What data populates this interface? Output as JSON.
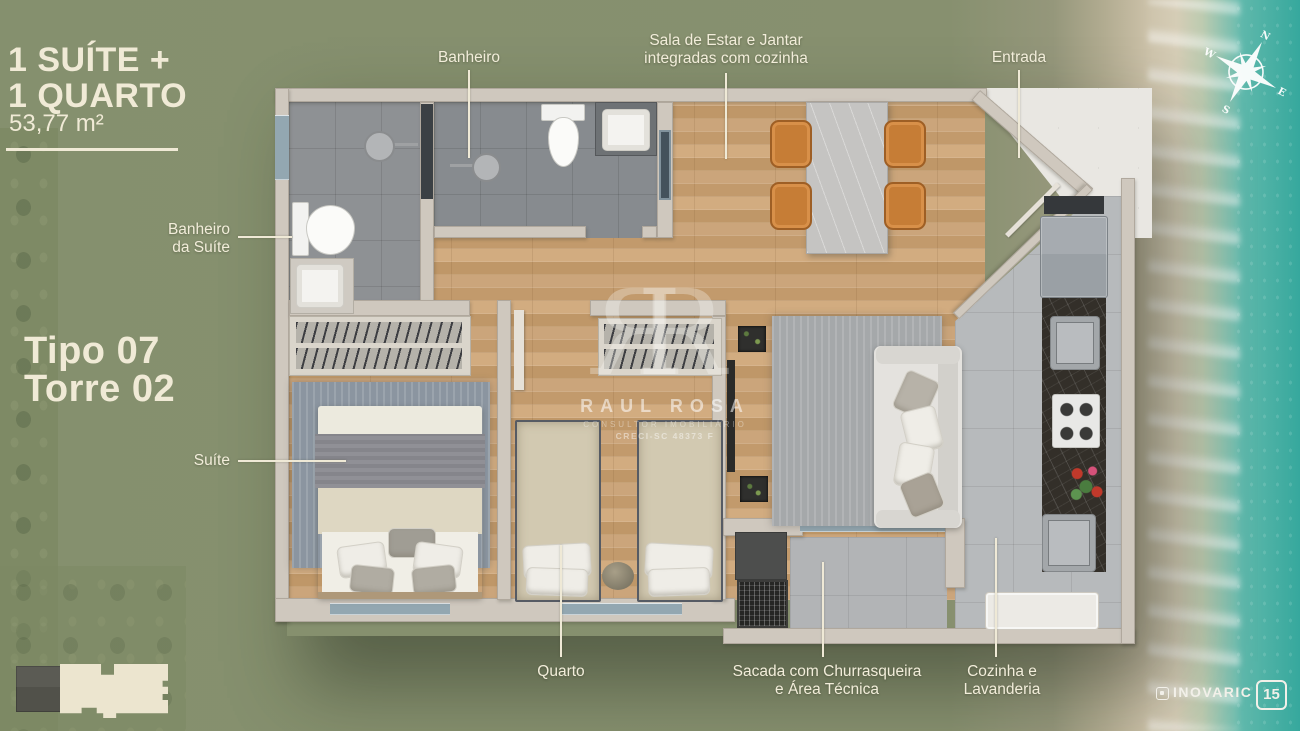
{
  "title_block": {
    "line1": "1 SUÍTE +",
    "line2": "1 QUARTO",
    "area": "53,77 m²"
  },
  "unit_block": {
    "line1": "Tipo 07",
    "line2": "Torre 02"
  },
  "callouts": {
    "banheiro": {
      "label": "Banheiro"
    },
    "sala": {
      "line1": "Sala de Estar e Jantar",
      "line2": "integradas com cozinha"
    },
    "entrada": {
      "label": "Entrada"
    },
    "banheiro_suite": {
      "line1": "Banheiro",
      "line2": "da Suíte"
    },
    "suite": {
      "label": "Suíte"
    },
    "quarto": {
      "label": "Quarto"
    },
    "sacada": {
      "line1": "Sacada com Churrasqueira",
      "line2": "e Área Técnica"
    },
    "cozinha": {
      "line1": "Cozinha e",
      "line2": "Lavanderia"
    }
  },
  "compass": {
    "n": "N",
    "e": "E",
    "s": "S",
    "w": "W"
  },
  "watermark": {
    "monogram_left": "R",
    "monogram_right": "R",
    "name": "RAUL ROSA",
    "subtitle": "CONSULTOR IMOBILIÁRIO",
    "creci": "CRECI-SC 48373 F"
  },
  "branding": {
    "developer": "INOVARIC",
    "badge": "15"
  },
  "colors": {
    "background_green": "#87906F",
    "text_cream": "#F2EDDA",
    "wood_floor": "#C8A277",
    "wall": "#CFC8BE",
    "ocean": "#2DA59B",
    "sand": "#C9BFA8",
    "chair_orange": "#C67D36"
  }
}
